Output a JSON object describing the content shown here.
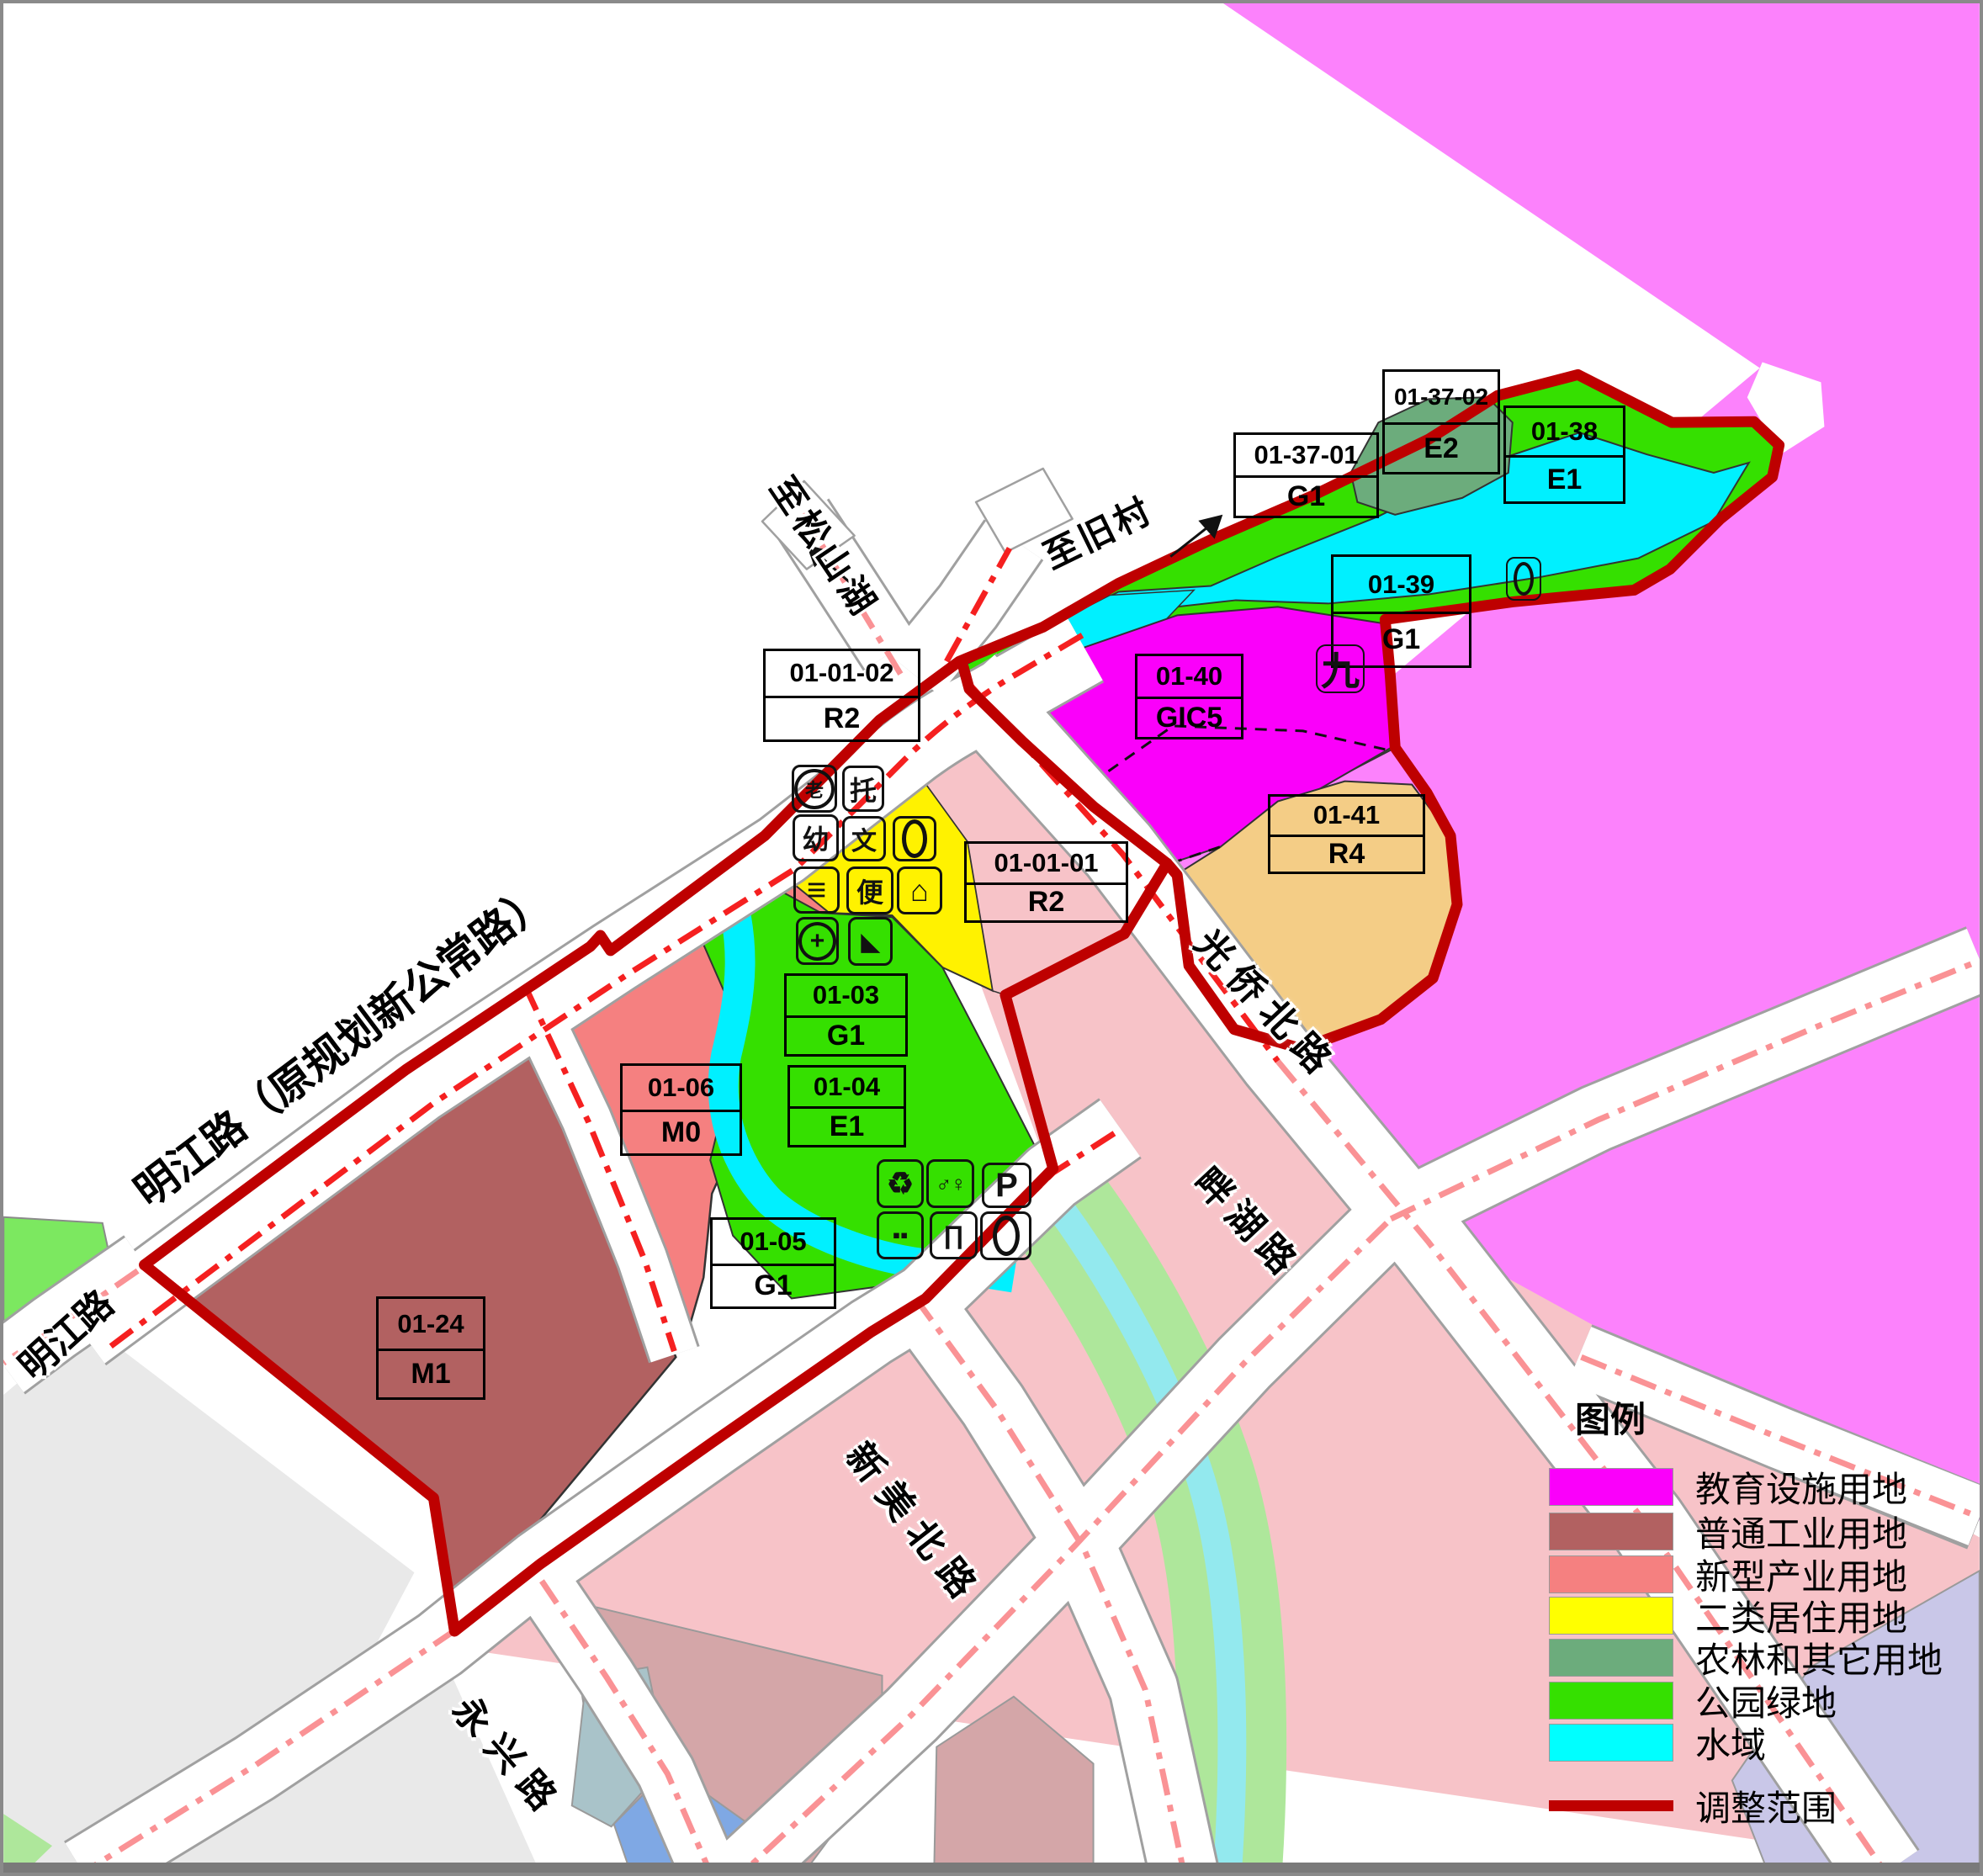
{
  "colors": {
    "boundary": "#be0000",
    "education_magenta": "#fa00fa",
    "faded_magenta": "#fc82fc",
    "industry_brown": "#b26161",
    "new_industry_salmon": "#f58080",
    "residential_yellow": "#fff200",
    "agriculture_graygreen": "#6cac7c",
    "park_green": "#35e000",
    "water_cyan": "#00f0ff",
    "residential_r4_tan": "#f4cd86",
    "faded_pink": "#f7c3c8",
    "faded_mauve": "#d4a6a8",
    "faded_gray": "#e9e9e9",
    "road_centerline_red": "#f52020",
    "road_centerline_pink": "#fa9295"
  },
  "map": {
    "parcels": [
      {
        "code": "01-01-02",
        "use": "R2"
      },
      {
        "code": "01-01-01",
        "use": "R2"
      },
      {
        "code": "01-03",
        "use": "G1"
      },
      {
        "code": "01-04",
        "use": "E1"
      },
      {
        "code": "01-05",
        "use": "G1"
      },
      {
        "code": "01-06",
        "use": "M0"
      },
      {
        "code": "01-24",
        "use": "M1"
      },
      {
        "code": "01-37-01",
        "use": "G1"
      },
      {
        "code": "01-37-02",
        "use": "E2"
      },
      {
        "code": "01-38",
        "use": "E1"
      },
      {
        "code": "01-39",
        "use": "G1"
      },
      {
        "code": "01-40",
        "use": "GIC5"
      },
      {
        "code": "01-41",
        "use": "R4"
      }
    ],
    "roads": [
      {
        "name": "明江路（原规划新公常路）"
      },
      {
        "name": "明江路"
      },
      {
        "name": "永兴路"
      },
      {
        "name": "新美北路"
      },
      {
        "name": "光侨北路"
      },
      {
        "name": "畔湖路"
      }
    ],
    "directions": [
      {
        "text": "至松山湖"
      },
      {
        "text": "至旧村"
      }
    ],
    "marker": "九",
    "icons_yellow": [
      {
        "name": "elderly-care",
        "glyph": "老"
      },
      {
        "name": "childcare",
        "glyph": "托"
      },
      {
        "name": "kindergarten",
        "glyph": "幼"
      },
      {
        "name": "culture-facility",
        "glyph": "文"
      },
      {
        "name": "public-toilet-oval",
        "glyph": ""
      },
      {
        "name": "market",
        "glyph": "≡"
      },
      {
        "name": "convenience-service",
        "glyph": "便"
      },
      {
        "name": "community-house",
        "glyph": "⌂"
      },
      {
        "name": "clinic",
        "glyph": "+"
      },
      {
        "name": "playground-slide",
        "glyph": "◣"
      }
    ],
    "icons_green": [
      {
        "name": "recycling-point",
        "glyph": "♻"
      },
      {
        "name": "public-restroom",
        "glyph": "♂♀"
      },
      {
        "name": "parking",
        "glyph": "P"
      },
      {
        "name": "waste-bins",
        "glyph": "▪▪"
      },
      {
        "name": "outdoor-seating",
        "glyph": "∏"
      },
      {
        "name": "oval-facility",
        "glyph": ""
      }
    ]
  },
  "legend": {
    "title": "图例",
    "items": [
      {
        "label": "教育设施用地",
        "color": "#fa00fa"
      },
      {
        "label": "普通工业用地",
        "color": "#b26161"
      },
      {
        "label": "新型产业用地",
        "color": "#f58080"
      },
      {
        "label": "二类居住用地",
        "color": "#ffff00"
      },
      {
        "label": "农林和其它用地",
        "color": "#6cac7c"
      },
      {
        "label": "公园绿地",
        "color": "#35e000"
      },
      {
        "label": "水域",
        "color": "#00ffff"
      }
    ],
    "boundary_label": "调整范围"
  }
}
